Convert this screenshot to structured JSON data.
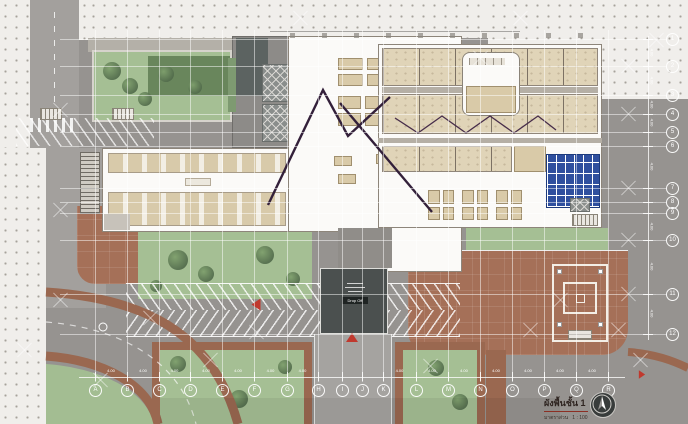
{
  "title_block": {
    "title": "ผังพื้นชั้น 1",
    "scale_label": "มาตราส่วน",
    "scale_value": "1 : 100"
  },
  "canopy": {
    "badge": "Drop Off"
  },
  "grid": {
    "dim_label": "4.00",
    "columns": [
      {
        "label": "A",
        "x": 95
      },
      {
        "label": "B",
        "x": 127
      },
      {
        "label": "C",
        "x": 159
      },
      {
        "label": "D",
        "x": 190
      },
      {
        "label": "E",
        "x": 222
      },
      {
        "label": "F",
        "x": 254
      },
      {
        "label": "G",
        "x": 287
      },
      {
        "label": "H",
        "x": 318
      },
      {
        "label": "I",
        "x": 342
      },
      {
        "label": "J",
        "x": 362
      },
      {
        "label": "K",
        "x": 383
      },
      {
        "label": "L",
        "x": 416
      },
      {
        "label": "M",
        "x": 448
      },
      {
        "label": "N",
        "x": 480
      },
      {
        "label": "O",
        "x": 512
      },
      {
        "label": "P",
        "x": 544
      },
      {
        "label": "Q",
        "x": 576
      },
      {
        "label": "R",
        "x": 608
      }
    ],
    "rows": [
      {
        "label": "1",
        "y": 39
      },
      {
        "label": "2",
        "y": 66
      },
      {
        "label": "3",
        "y": 95
      },
      {
        "label": "4",
        "y": 114
      },
      {
        "label": "5",
        "y": 132
      },
      {
        "label": "6",
        "y": 146
      },
      {
        "label": "7",
        "y": 188
      },
      {
        "label": "8",
        "y": 202
      },
      {
        "label": "9",
        "y": 213
      },
      {
        "label": "10",
        "y": 240
      },
      {
        "label": "11",
        "y": 294
      },
      {
        "label": "12",
        "y": 334
      }
    ],
    "xmarks": [
      [
        628,
        66
      ],
      [
        628,
        114
      ],
      [
        628,
        188
      ],
      [
        628,
        240
      ],
      [
        628,
        294
      ],
      [
        656,
        40
      ],
      [
        618,
        330
      ],
      [
        60,
        110
      ],
      [
        60,
        210
      ],
      [
        60,
        300
      ],
      [
        24,
        350
      ],
      [
        150,
        318
      ],
      [
        210,
        360
      ],
      [
        430,
        366
      ],
      [
        530,
        330
      ],
      [
        560,
        300
      ],
      [
        480,
        58
      ],
      [
        300,
        18
      ],
      [
        520,
        18
      ],
      [
        640,
        360
      ],
      [
        100,
        380
      ],
      [
        256,
        332
      ]
    ]
  },
  "colors": {
    "base_gray": "#969390",
    "plaza_dots": "#f0eeeb",
    "grass": "#a5bf94",
    "brown_paving": "#a57058",
    "building_white": "#fbfaf8",
    "furniture_beige": "#e0d4b8",
    "shelving_blue": "#2f4f9e",
    "canopy_dark": "#4b504f",
    "section_line_maroon": "#33203a",
    "marker_red": "#c0392e"
  },
  "icons": {
    "north_arrow": "north-arrow"
  }
}
